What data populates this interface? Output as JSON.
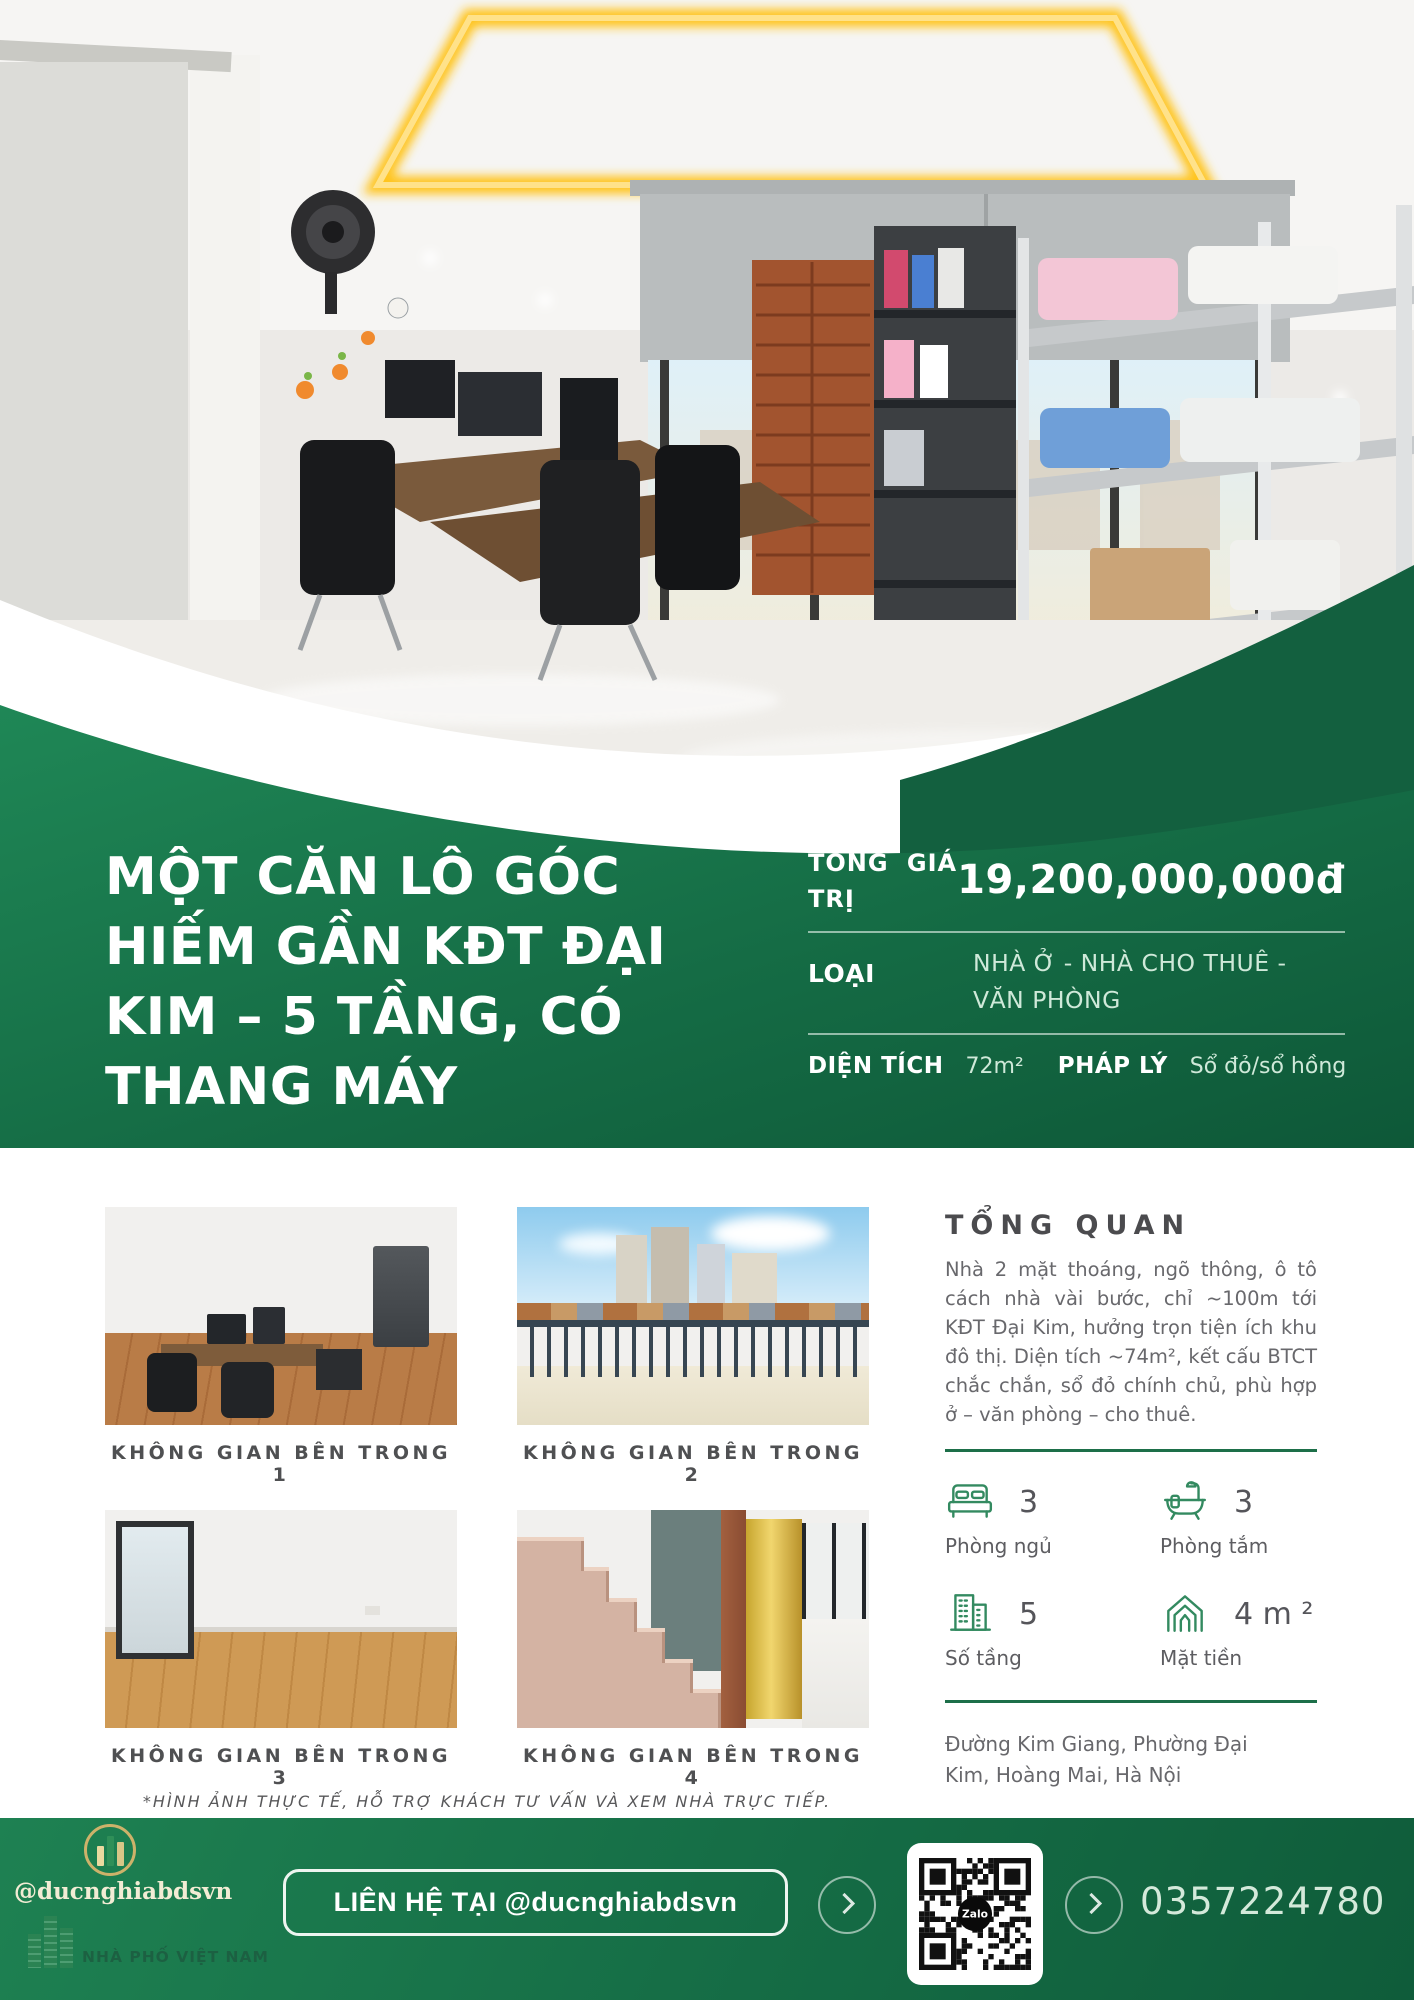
{
  "title_lines": [
    "MỘT CĂN LÔ GÓC",
    "HIẾM GẦN KĐT ĐẠI",
    "KIM – 5 TẦNG, CÓ",
    "THANG MÁY"
  ],
  "pricing": {
    "label": "TỔNG GIÁ TRỊ",
    "value": "19,200,000,000đ"
  },
  "rows": {
    "type_label": "LOẠI",
    "type_value": "NHÀ Ở - NHÀ CHO THUÊ - VĂN PHÒNG",
    "area_label": "DIỆN TÍCH",
    "area_value": "72m²",
    "legal_label": "PHÁP LÝ",
    "legal_value": "Sổ đỏ/sổ hồng"
  },
  "gallery": {
    "captions": [
      "KHÔNG GIAN BÊN TRONG 1",
      "KHÔNG GIAN BÊN TRONG 2",
      "KHÔNG GIAN BÊN TRONG 3",
      "KHÔNG GIAN BÊN TRONG 4"
    ]
  },
  "overview": {
    "heading": "TỔNG QUAN",
    "body": "Nhà 2 mặt thoáng, ngõ thông, ô tô cách nhà vài bước, chỉ ~100m tới KĐT Đại Kim, hưởng trọn tiện ích khu đô thị. Diện tích ~74m², kết cấu BTCT chắc chắn, sổ đỏ chính chủ, phù hợp ở – văn phòng – cho thuê."
  },
  "stats": [
    {
      "icon": "bed-icon",
      "value": "3",
      "label": "Phòng ngủ"
    },
    {
      "icon": "bath-icon",
      "value": "3",
      "label": "Phòng tắm"
    },
    {
      "icon": "building-icon",
      "value": "5",
      "label": "Số tầng"
    },
    {
      "icon": "house-icon",
      "value": "4 m ²",
      "label": "Mặt tiền"
    }
  ],
  "address": "Đường Kim Giang, Phường Đại Kim, Hoàng Mai, Hà Nội",
  "disclaimer": "*HÌNH ẢNH THỰC TẾ, HỖ TRỢ KHÁCH TƯ VẤN VÀ XEM NHÀ TRỰC TIẾP.",
  "footer": {
    "handle": "@ducnghiabdsvn",
    "brand": "NHÀ PHỐ VIỆT NAM",
    "contact": "LIÊN HỆ TẠI @ducnghiabdsvn",
    "phone": "0357224780",
    "qr_label": "Zalo"
  },
  "colors": {
    "green": "#177449",
    "green_dark": "#0f5c3a",
    "mint": "#cfe9d9",
    "divider_green": "#1d6f49",
    "led_yellow": "#ffc41f"
  }
}
